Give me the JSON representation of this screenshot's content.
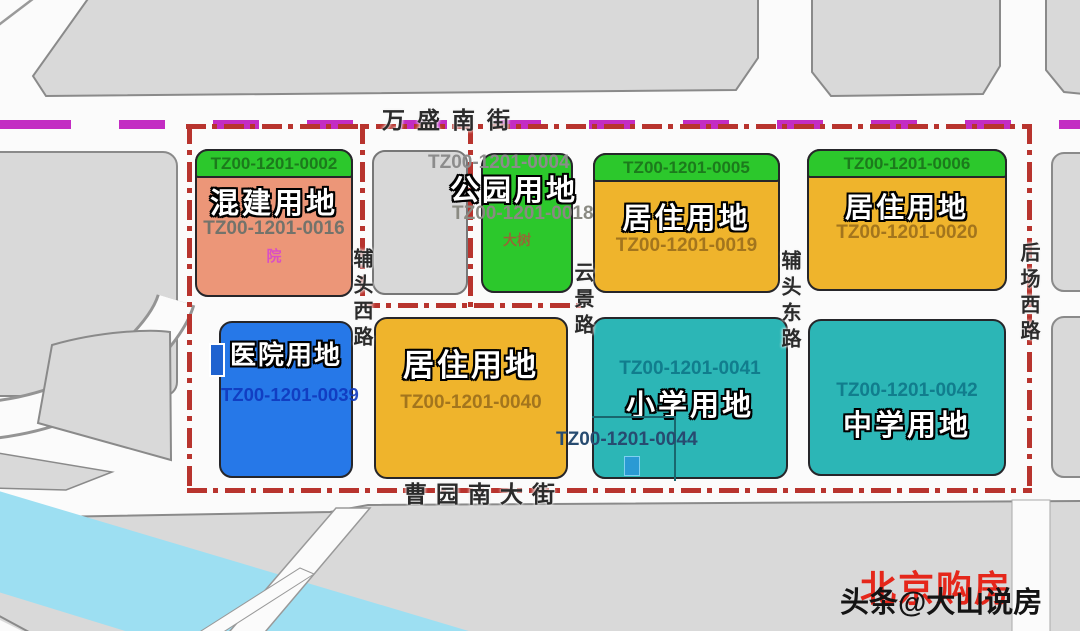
{
  "roads": {
    "top": "万盛南街",
    "bottom": "曹园南大街",
    "west_vertical": "辅头西路",
    "mid_vertical": "云景路",
    "east_vertical": "辅头东路",
    "right_vertical": "后场西路"
  },
  "parcels": [
    {
      "name": "mixed-use",
      "label": "混建用地",
      "strip_code": "TZ00-1201-0002",
      "code": "TZ00-1201-0016",
      "small_text": "院"
    },
    {
      "name": "park",
      "label": "公园用地",
      "above_code": "TZ00-1201-0004",
      "code": "TZ00-1201-0018",
      "small_text": "大树"
    },
    {
      "name": "residential-1",
      "label": "居住用地",
      "strip_code": "TZ00-1201-0005",
      "code": "TZ00-1201-0019"
    },
    {
      "name": "residential-2",
      "label": "居住用地",
      "strip_code": "TZ00-1201-0006",
      "code": "TZ00-1201-0020"
    },
    {
      "name": "hospital",
      "label": "医院用地",
      "code": "TZ00-1201-0039"
    },
    {
      "name": "residential-3",
      "label": "居住用地",
      "code": "TZ00-1201-0040"
    },
    {
      "name": "primary-school",
      "label": "小学用地",
      "code": "TZ00-1201-0041",
      "sub_code": "TZ00-1201-0044"
    },
    {
      "name": "middle-school",
      "label": "中学用地",
      "code": "TZ00-1201-0042"
    }
  ],
  "watermark": {
    "red_text": "北京购房",
    "black_text": "头条@大山说房"
  },
  "colors": {
    "boundary_red": "#b8342e",
    "metro_purple": "#c32cc3",
    "mixed_use_salmon": "#ec9678",
    "green": "#2cc82c",
    "residential_orange": "#efb42c",
    "hospital_blue": "#2678e8",
    "school_teal": "#2cb6b6",
    "river_blue": "#9ddff2",
    "block_gray": "#d9d9d9"
  }
}
